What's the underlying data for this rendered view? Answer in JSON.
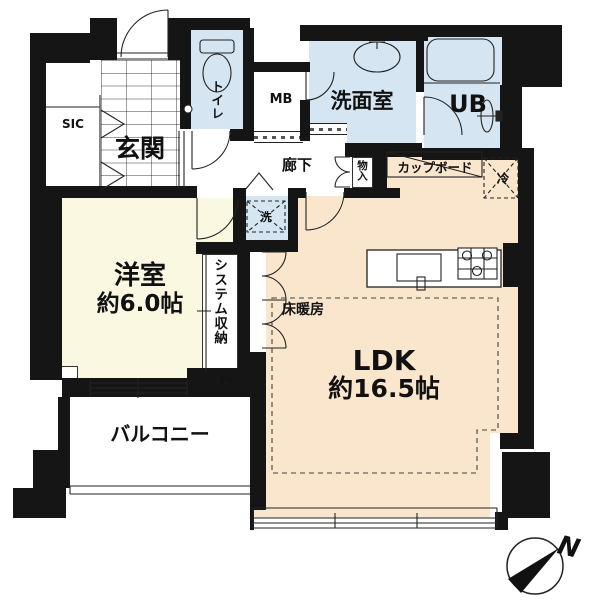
{
  "colors": {
    "wall": "#151515",
    "wet": "#D5E6F2",
    "room": "#FBF8E2",
    "ldk": "#F9E6CC",
    "line": "#222222"
  },
  "plan": {
    "entrance": {
      "label": "玄関"
    },
    "shoe_closet": {
      "label": "SIC"
    },
    "toilet": {
      "label": "トイレ"
    },
    "meter_box": {
      "label": "MB"
    },
    "washroom": {
      "label": "洗面室"
    },
    "bathroom": {
      "label": "UB"
    },
    "corridor": {
      "label": "廊下"
    },
    "storage": {
      "label": "物入"
    },
    "cupboard": {
      "label": "カップボード"
    },
    "refrigerator": {
      "label": "冷"
    },
    "washer": {
      "label": "洗"
    },
    "western_room": {
      "label": "洋室",
      "area": "約6.0帖"
    },
    "system_storage": {
      "label": "システム収納"
    },
    "pipe_space": {
      "label": "PS"
    },
    "ldk": {
      "label": "LDK",
      "area": "約16.5帖"
    },
    "floor_heating": {
      "label": "床暖房"
    },
    "balcony": {
      "label": "バルコニー"
    },
    "compass_north": {
      "label": "N"
    }
  }
}
